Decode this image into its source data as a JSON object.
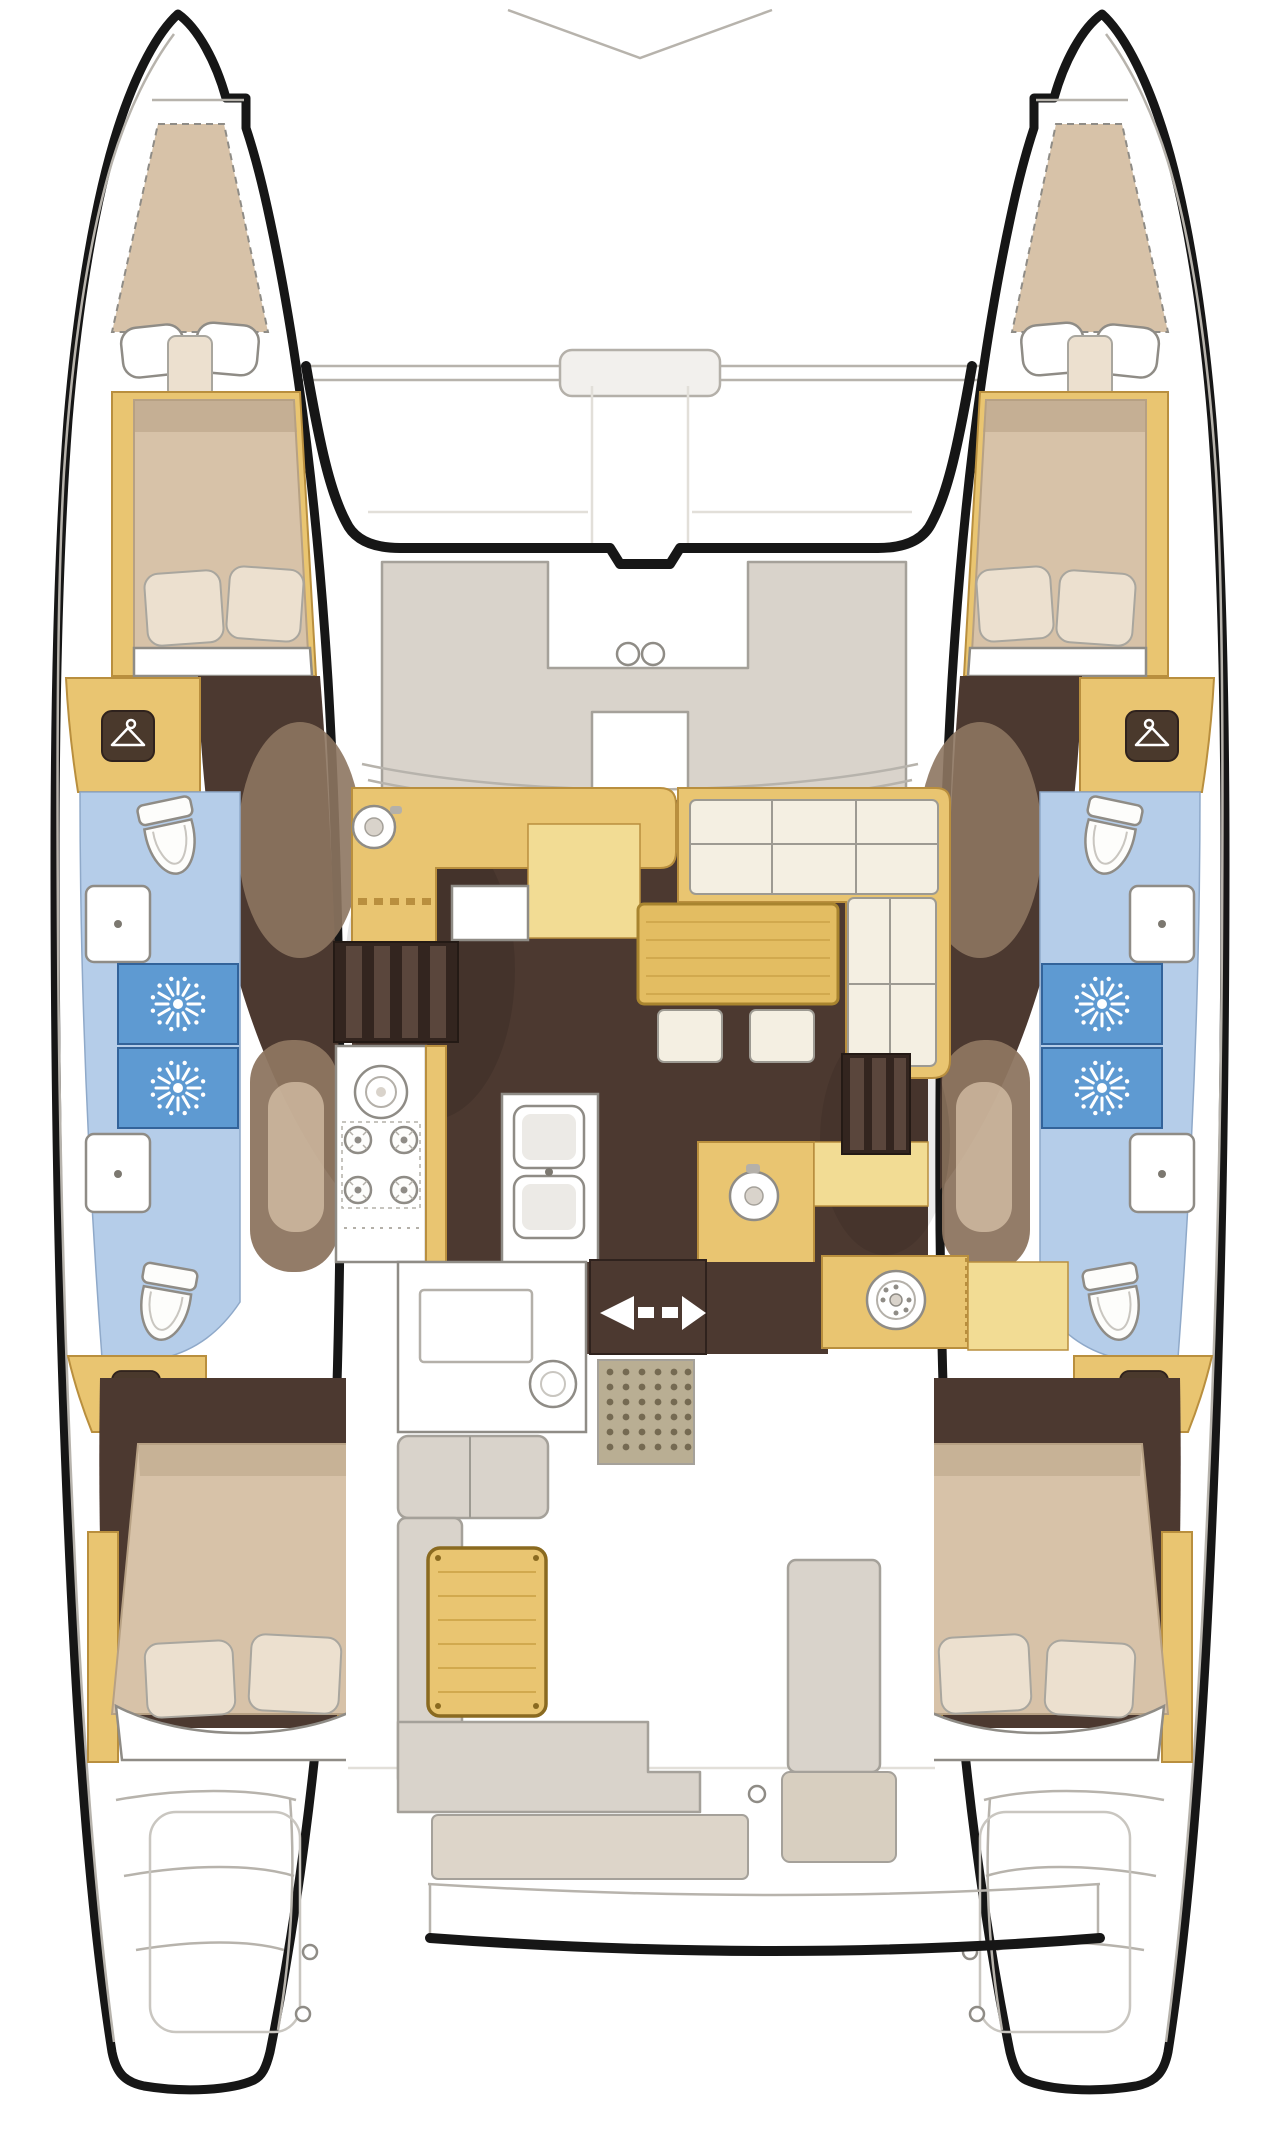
{
  "diagram": {
    "type": "floor-plan",
    "subject": "sailing catamaran deck and accommodation layout, top-down view, bow up",
    "hulls": 2,
    "symmetry": "port and starboard hulls are mirrored",
    "hull_features": [
      "forepeak-berth",
      "forward-double-bed-with-pillows",
      "wardrobe",
      "hanging-locker",
      "bathroom-toilet",
      "bathroom-sink",
      "shower-stall-forward",
      "shower-stall-aft",
      "aft-bathroom-sink",
      "aft-bathroom-toilet",
      "aft-hanging-locker",
      "aft-double-bed-with-pillows",
      "stern-swim-steps"
    ],
    "center_features": [
      "bow-bridle-lines",
      "forward-crossbeam",
      "forward-cockpit-c-seat",
      "two-deck-hatches",
      "coachroof-windshield",
      "galley-l-counter-with-round-sink",
      "chart-table",
      "port-companionway-steps",
      "stove-four-burners-and-oven",
      "galley-double-sink",
      "l-shaped-sofa",
      "dinette-table",
      "two-stools",
      "aft-counter-with-round-sink",
      "starboard-companionway-steps",
      "sliding-door-with-direction-arrows",
      "doormat",
      "cockpit-counter-with-winch",
      "port-cockpit-bench",
      "cockpit-table",
      "aft-bench",
      "helm-seat",
      "aft-transom-beam",
      "swim-platform-steps"
    ],
    "counts": {
      "double_beds": 4,
      "forepeak_berths": 2,
      "toilets": 4,
      "shower_stalls": 4,
      "bathroom_sinks": 4,
      "hanging_lockers": 4,
      "stove_burners": 4,
      "deck_hatches": 2,
      "stools": 2,
      "door_arrows": 2
    }
  },
  "palette": {
    "paper": "#ffffff",
    "ink": "#161616",
    "line-light": "#b7b3ac",
    "line-faint": "#e2dfd9",
    "wood": "#e9c571",
    "wood-border": "#b98f3e",
    "wood-light": "#f2dc94",
    "bed": "#d7c2a8",
    "bed-border": "#b7a184",
    "pillow": "#ece0cf",
    "pillow-border": "#a9a69e",
    "cushion": "#f4efe2",
    "cushion-border": "#9d9a92",
    "deck": "#d9d3cb",
    "deck-border": "#a5a19a",
    "beige": "#ddd5c9",
    "tan-seat": "#d8cfc0",
    "bath": "#b5cde9",
    "bath-border": "#8fa9c9",
    "shower": "#5e9ad2",
    "shower-border": "#33639a",
    "floor-dark": "#4c3930",
    "floor-steps": "#33251f",
    "wall-slat": "#5a463c",
    "wall-brown": "#8d7560",
    "fixture-border": "#8f8c86",
    "table": "#e3bd62",
    "table-border": "#a8842f",
    "table-grain": "#d1a94e",
    "mat": "#b9ae93",
    "mat-dot": "#756a52"
  }
}
